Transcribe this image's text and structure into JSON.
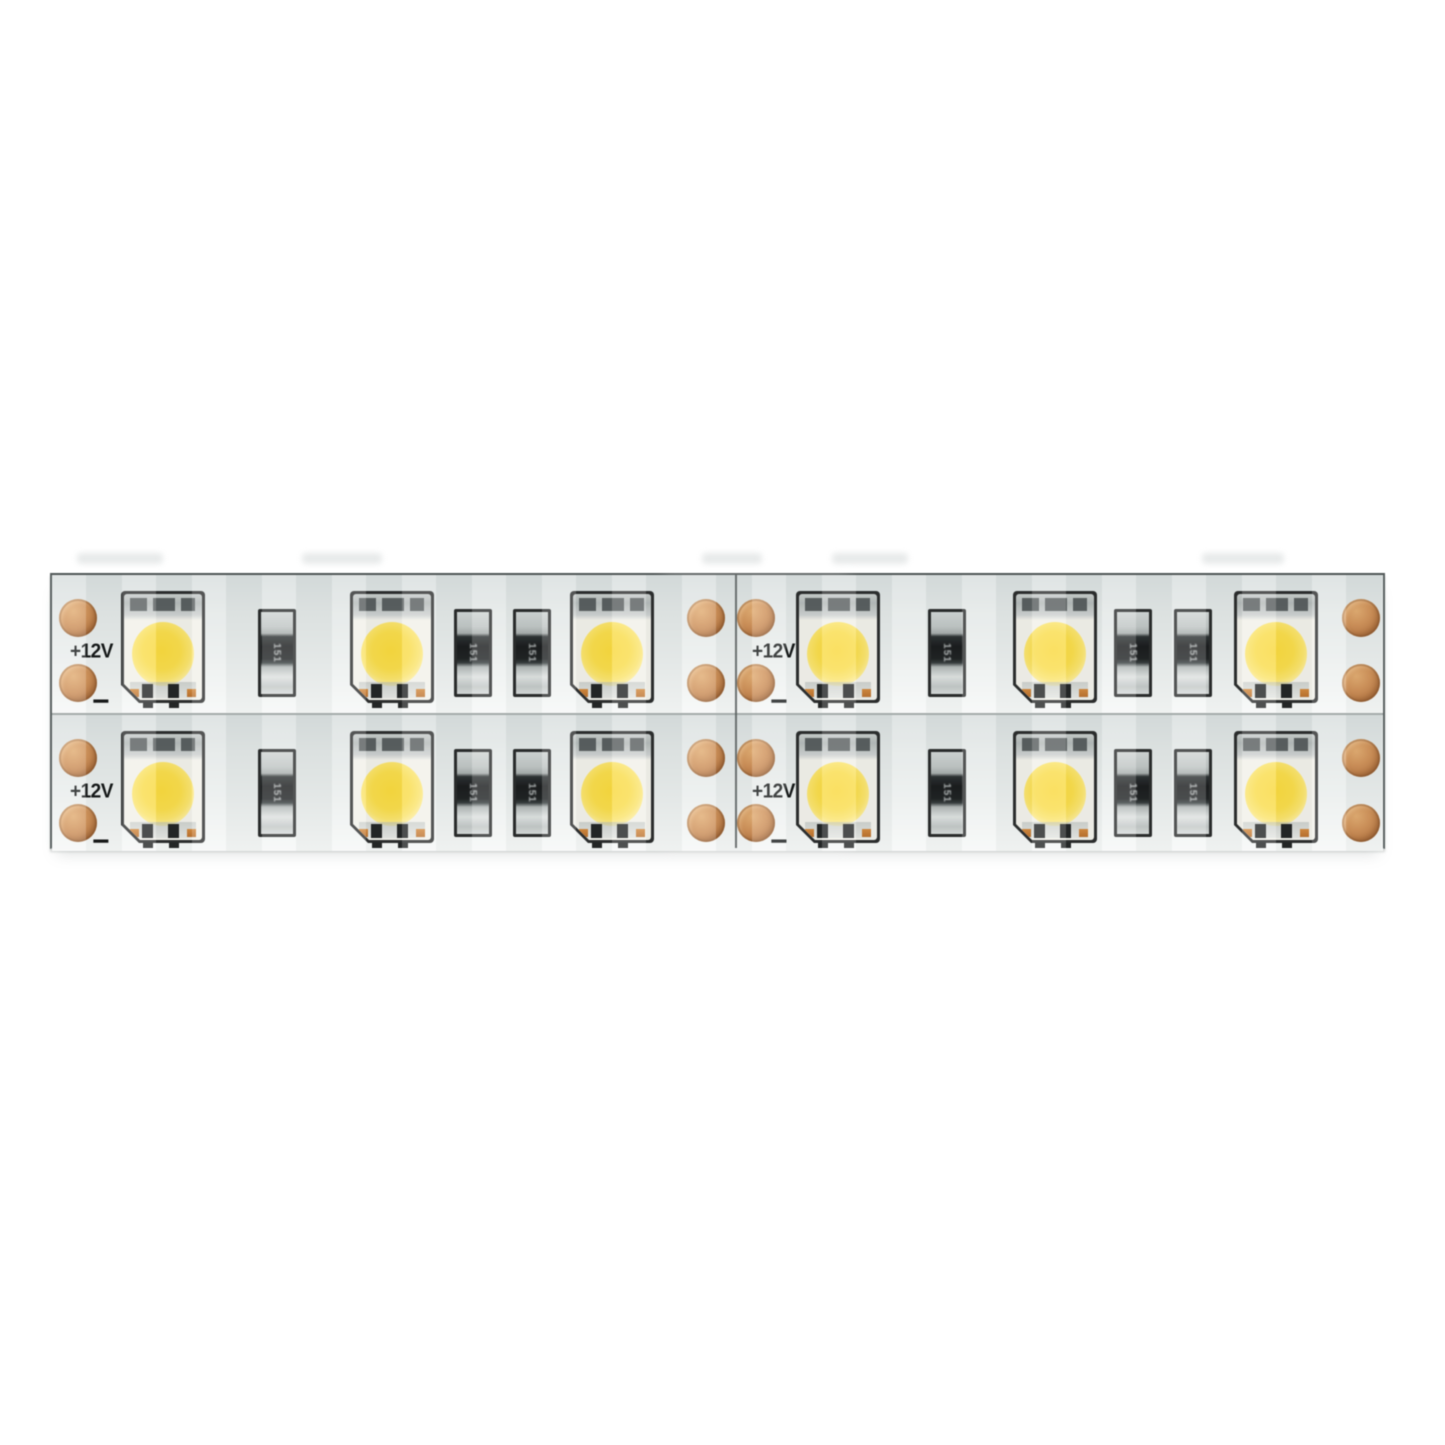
{
  "image": {
    "type": "product-photo",
    "subject": "Dual-row flexible LED strip light segment with warm-white SMD 5050 chips on a white PCB, photographed on a white background"
  },
  "strip": {
    "label_positive": "+12V",
    "label_negative": "−",
    "resistor_marking": "151",
    "rows": 2,
    "segments_per_row": 2,
    "leds_per_row": 6,
    "resistors_per_row": 6,
    "solder_pads_per_row": 8,
    "colors": {
      "background": "#ffffff",
      "pcb": "#e8eceb",
      "pcb_edge": "#545a5a",
      "copper_pad": "#c98c54",
      "led_phosphor_yellow": "#f8d83c",
      "led_outline": "#292b2b",
      "resistor_body": "#1d2021",
      "silkscreen_text": "#121515"
    }
  }
}
